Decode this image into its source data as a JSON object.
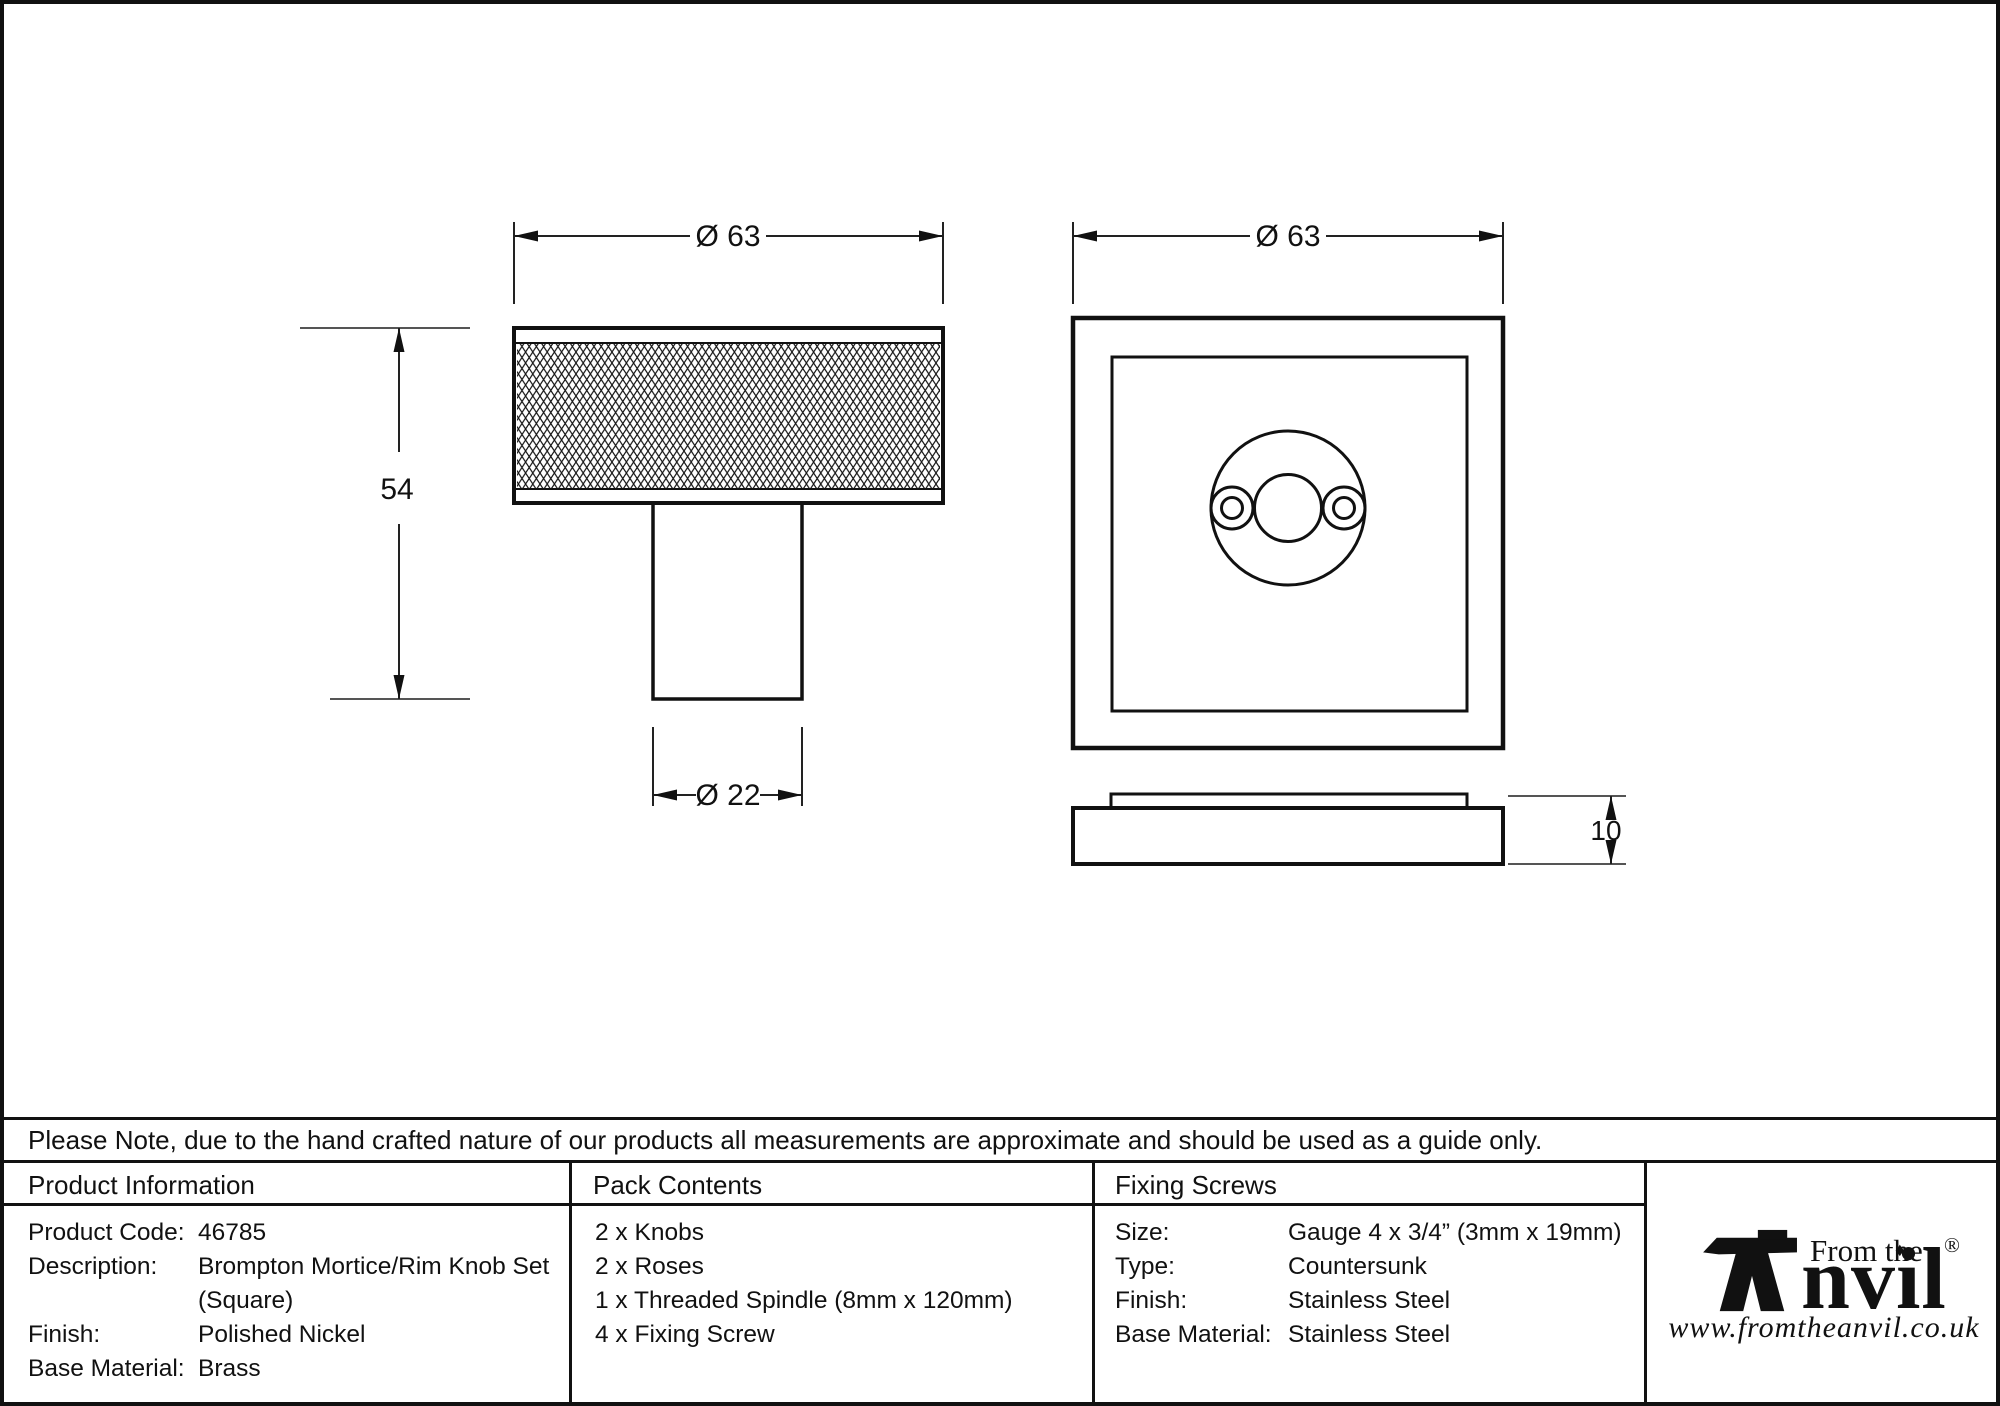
{
  "note": {
    "text": "Please Note, due to the hand crafted nature of our products all measurements are approximate and should be used as a guide only."
  },
  "dimensions": {
    "knob_diameter": "Ø 63",
    "knob_height": "54",
    "stem_diameter": "Ø 22",
    "rose_width": "Ø 63",
    "rose_thickness": "10"
  },
  "table": {
    "product_information": {
      "header": "Product Information",
      "rows": [
        {
          "label": "Product Code:",
          "value": "46785"
        },
        {
          "label": "Description:",
          "value": "Brompton Mortice/Rim Knob Set (Square)"
        },
        {
          "label": "Finish:",
          "value": "Polished Nickel"
        },
        {
          "label": "Base Material:",
          "value": "Brass"
        }
      ]
    },
    "pack_contents": {
      "header": "Pack Contents",
      "items": [
        "2 x Knobs",
        "2 x Roses",
        "1 x Threaded Spindle (8mm x 120mm)",
        "4 x Fixing Screw"
      ]
    },
    "fixing_screws": {
      "header": "Fixing Screws",
      "rows": [
        {
          "label": "Size:",
          "value": "Gauge 4 x 3/4” (3mm x 19mm)"
        },
        {
          "label": "Type:",
          "value": "Countersunk"
        },
        {
          "label": "Finish:",
          "value": "Stainless Steel"
        },
        {
          "label": "Base Material:",
          "value": "Stainless Steel"
        }
      ]
    }
  },
  "logo": {
    "from_the": "From the",
    "brand_suffix": "nvil",
    "diamond": "♦",
    "registered": "®",
    "url": "www.fromtheanvil.co.uk"
  },
  "colors": {
    "line": "#111111",
    "dim_line": "#222222",
    "tick": "#555555"
  }
}
